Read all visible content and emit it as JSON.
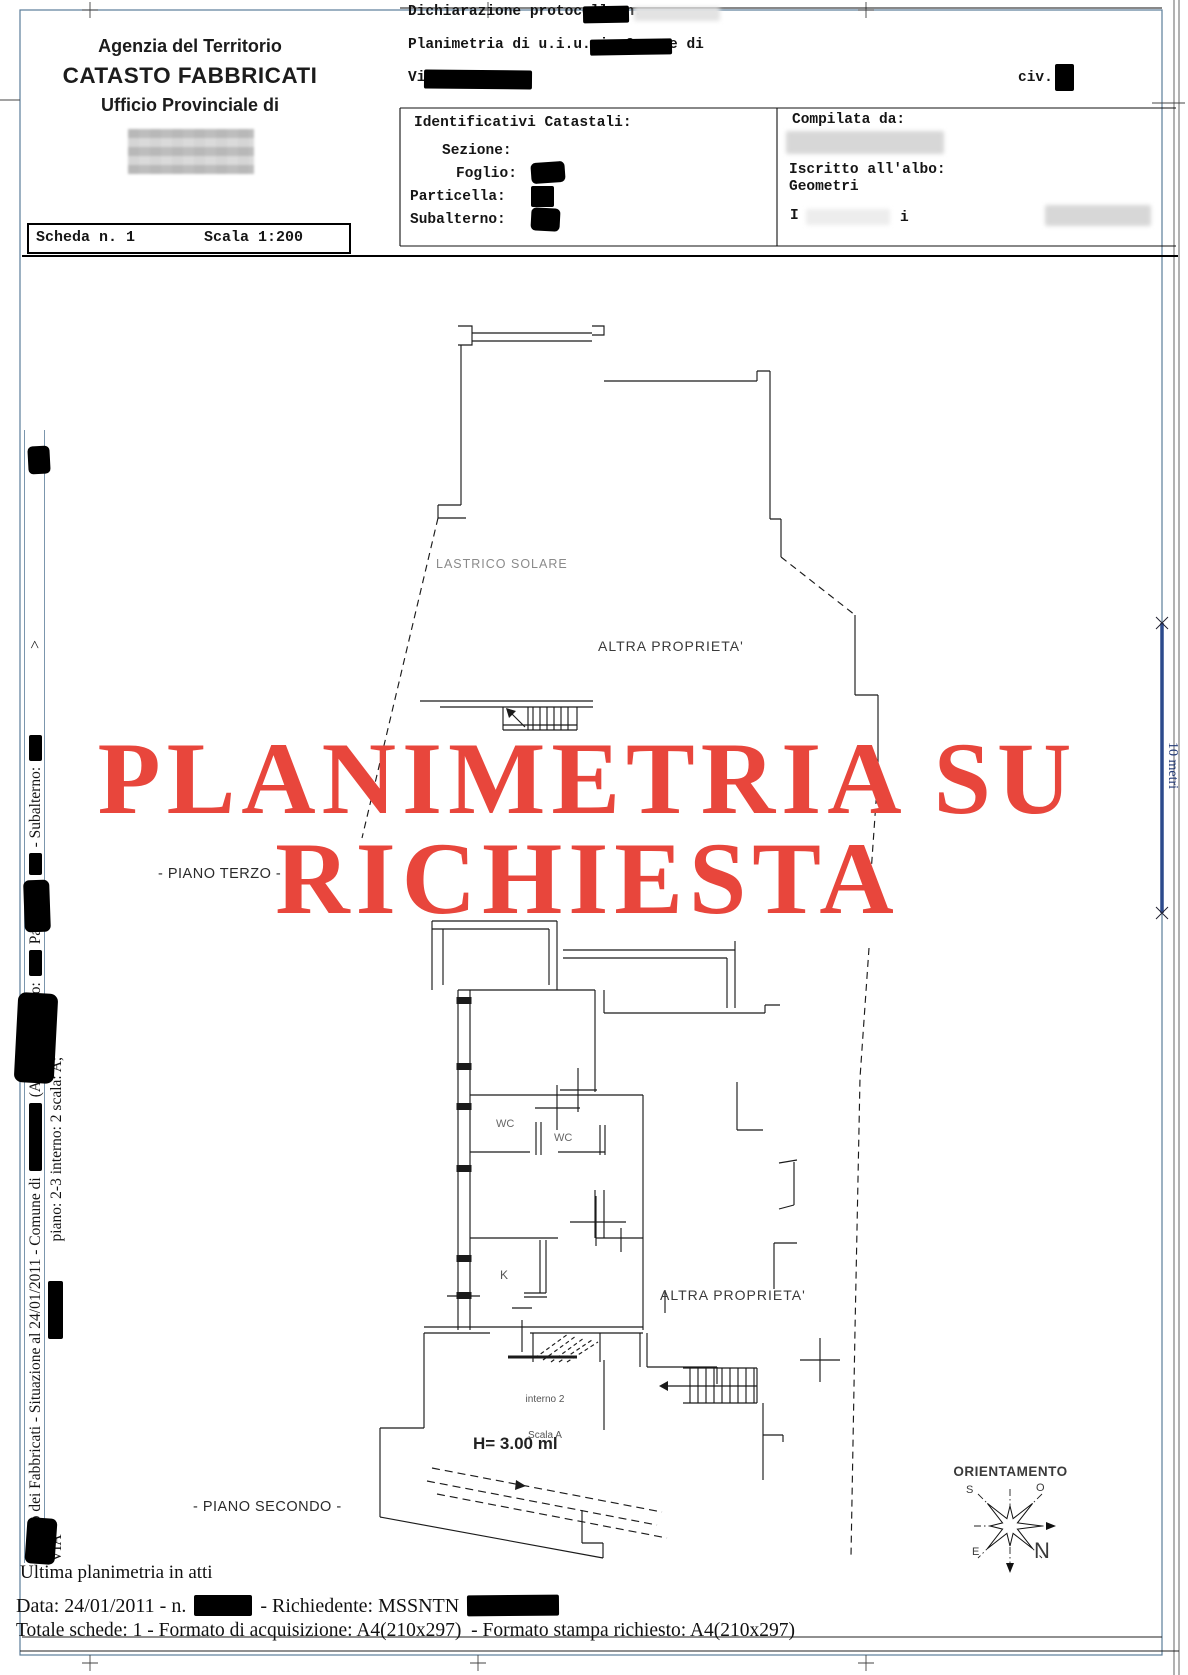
{
  "page": {
    "frame_color": "#5b7d99"
  },
  "header": {
    "agency_line1": "Agenzia del Territorio",
    "agency_line2": "CATASTO FABBRICATI",
    "agency_line3": "Ufficio Provinciale di",
    "protocol_line": "Dichiarazione protocollo n.",
    "planimetria_line": "Planimetria di u.i.u. in Comune di",
    "via_label": "Via",
    "civ_label": "civ.",
    "identificativi_title": "Identificativi Catastali:",
    "sezione_label": "Sezione:",
    "foglio_label": "Foglio:",
    "particella_label": "Particella:",
    "subalterno_label": "Subalterno:",
    "compilata_label": "Compilata da:",
    "albo_line1": "Iscritto all'albo:",
    "albo_line2": "Geometri",
    "name_fragment_left": "I",
    "name_fragment_right": "i"
  },
  "scheda": {
    "number": "Scheda n. 1",
    "scale": "Scala 1:200"
  },
  "watermark": {
    "line1": "PLANIMETRIA SU",
    "line2": "RICHIESTA",
    "color": "#e8463c"
  },
  "plan": {
    "lastrico_label": "LASTRICO SOLARE",
    "altra_proprieta_top": "ALTRA PROPRIETA'",
    "altra_proprieta_bottom": "ALTRA PROPRIETA'",
    "piano_terzo_label": "- PIANO TERZO -",
    "piano_secondo_label": "- PIANO SECONDO -",
    "wc_label_1": "WC",
    "wc_label_2": "WC",
    "kitchen_label": "K",
    "interno_line1": "interno 2",
    "interno_line2": "Scala A",
    "height_label": "H= 3.00 ml",
    "orientation_title": "ORIENTAMENTO",
    "compass_n": "N",
    "compass_s": "S",
    "compass_e": "E",
    "compass_o": "O"
  },
  "scale_bar": {
    "label": "10 metri",
    "color": "#2c4a8c"
  },
  "margin_left": {
    "line1_part1": "Catasto dei Fabbricati - Situazione al 24/01/2011 - Comune di",
    "line1_part2": "(A271) - <  Foglio:",
    "line1_part3": "Particella:",
    "line1_part4": "- Subalterno:",
    "line1_part5": ">",
    "line2_part1": "VIA",
    "line2_part2": "piano: 2-3 interno: 2 scala: A;"
  },
  "footer": {
    "line1": "Ultima planimetria in atti",
    "line2_part1": "Data: 24/01/2011 - n.",
    "line2_part2": "- Richiedente: MSSNTN",
    "line3": "Totale schede: 1 - Formato di acquisizione: A4(210x297)  - Formato stampa richiesto: A4(210x297)"
  }
}
